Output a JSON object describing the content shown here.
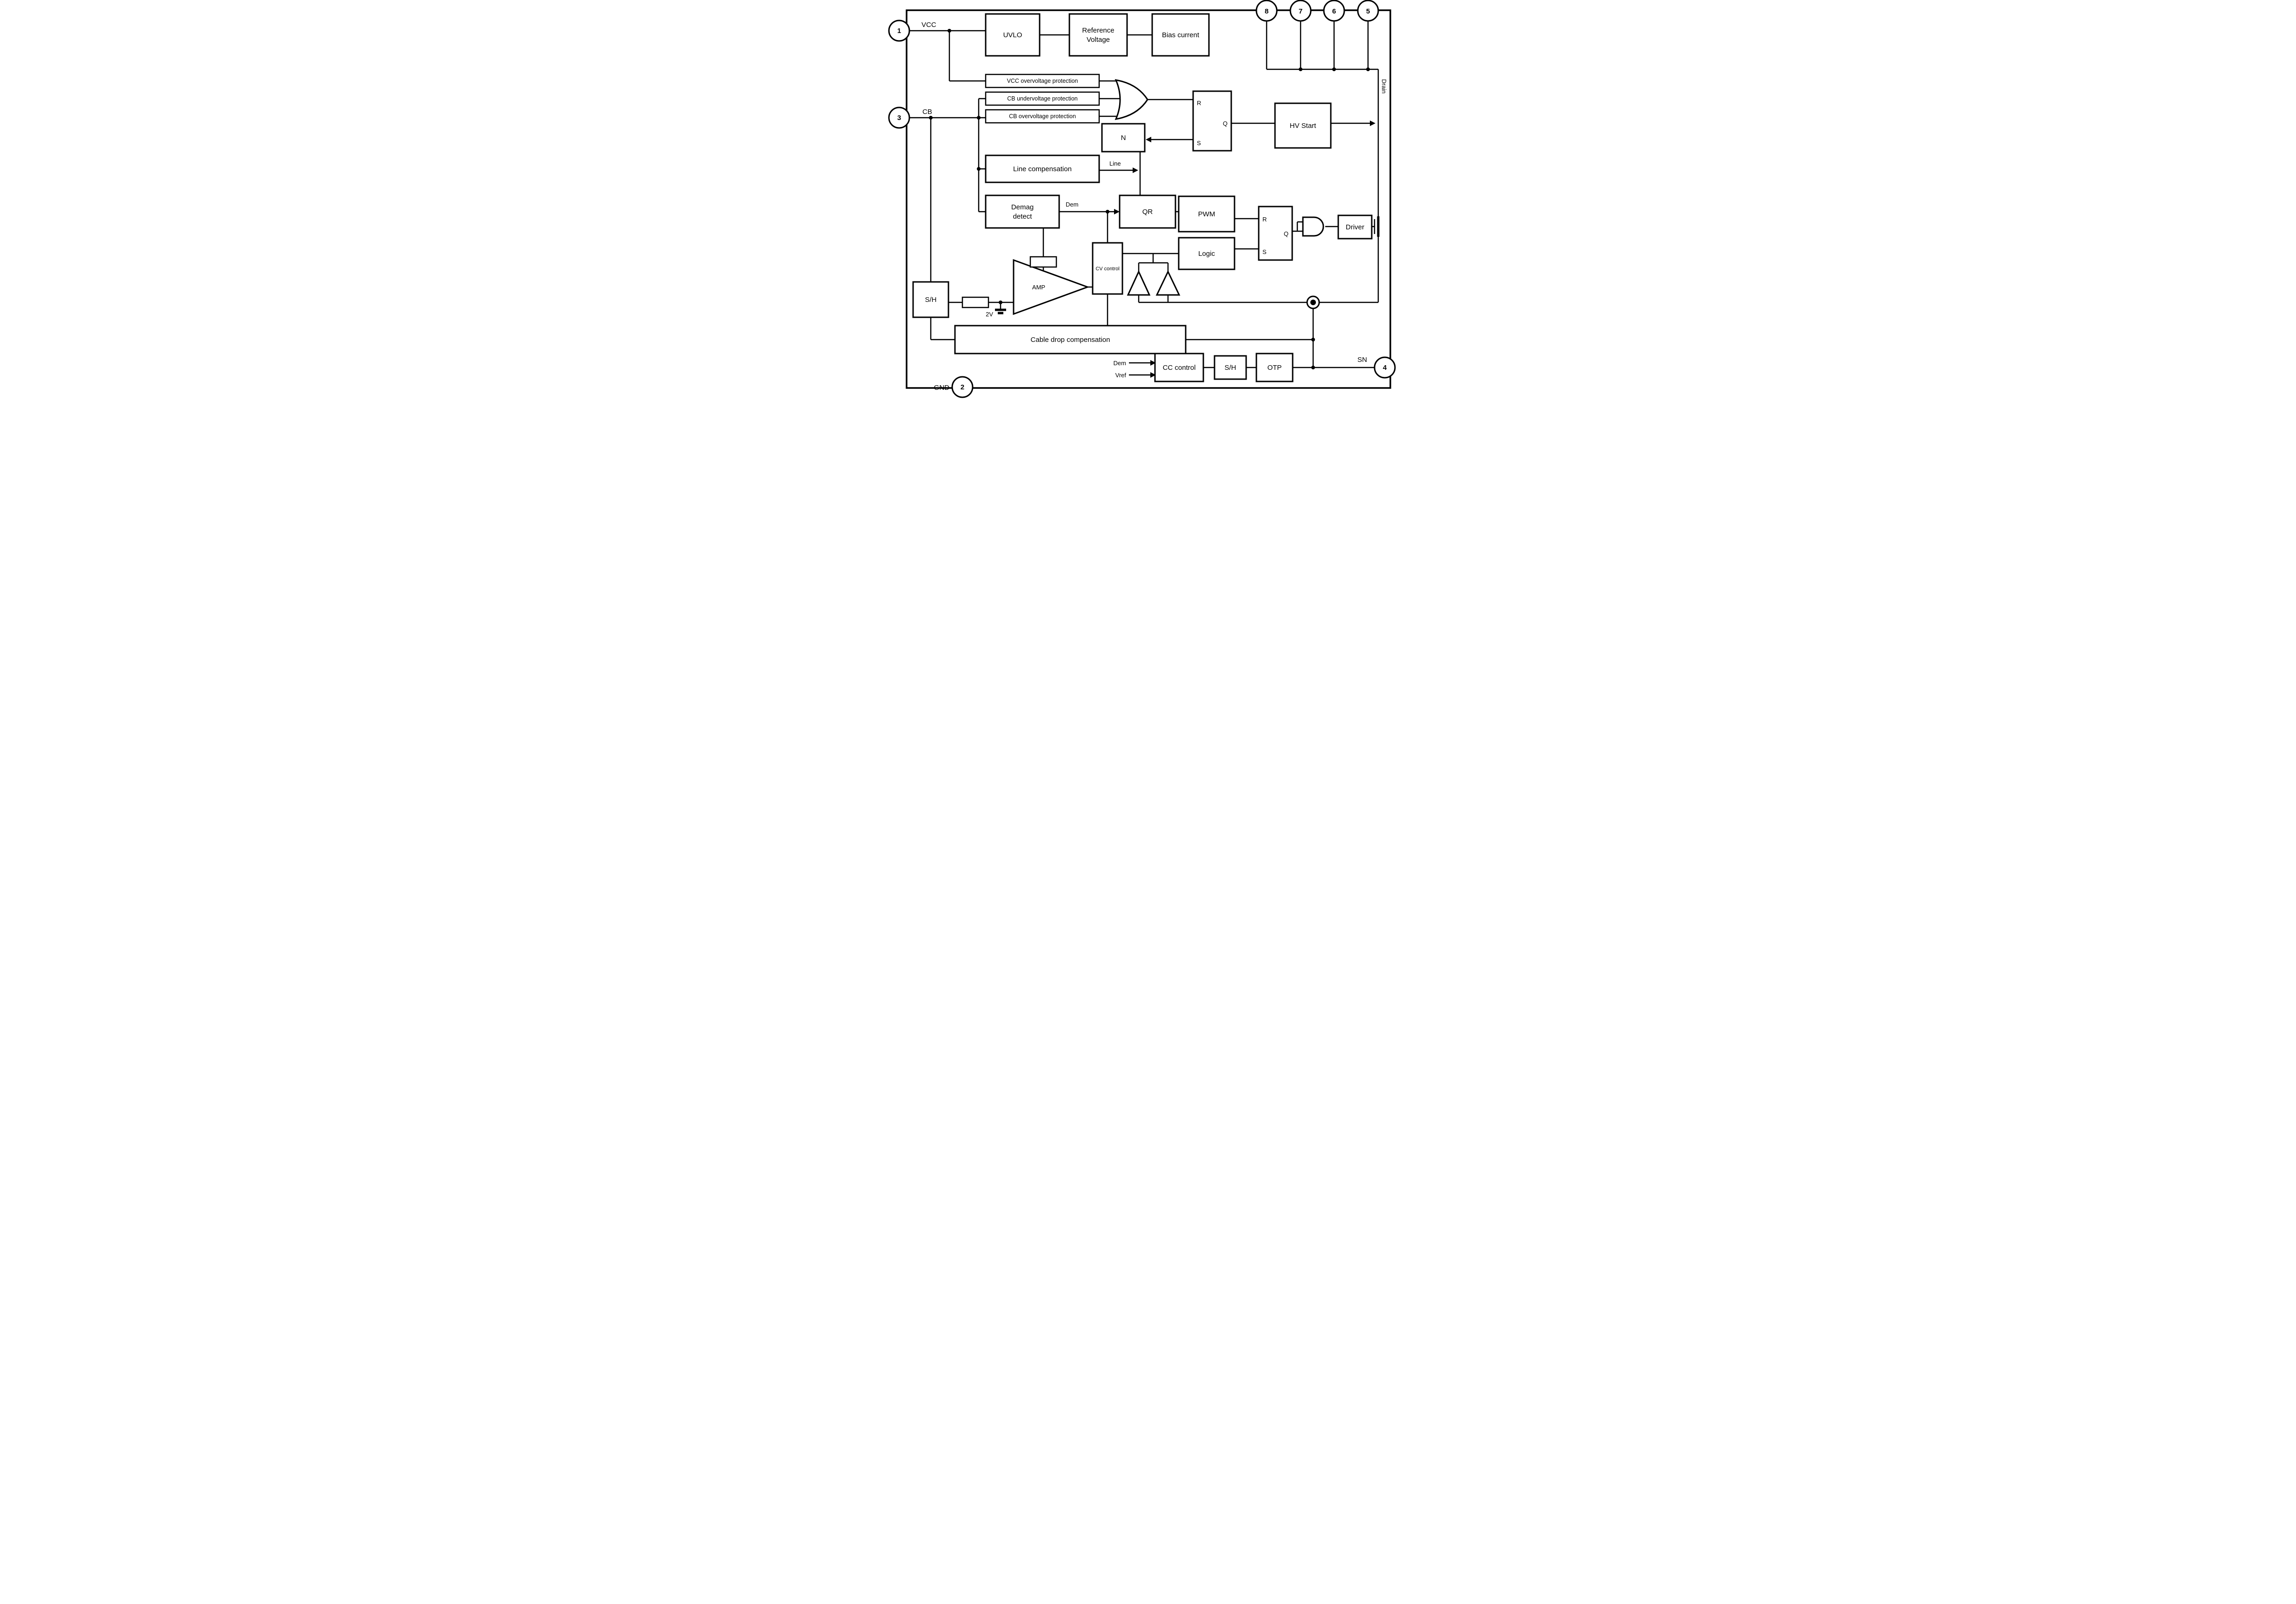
{
  "diagram": {
    "colors": {
      "line": "#000000",
      "background": "#ffffff"
    },
    "pins": {
      "p1": "1",
      "p2": "2",
      "p3": "3",
      "p4": "4",
      "p5": "5",
      "p6": "6",
      "p7": "7",
      "p8": "8"
    },
    "pin_names": {
      "vcc": "VCC",
      "gnd": "GND",
      "cb": "CB",
      "sn": "SN",
      "drain": "Drain"
    },
    "blocks": {
      "uvlo": "UVLO",
      "reference_line1": "Reference",
      "reference_line2": "Voltage",
      "bias": "Bias current",
      "vcc_ovp": "VCC overvoltage protection",
      "cb_uvp": "CB undervoltage protection",
      "cb_ovp": "CB overvoltage protection",
      "hv_start": "HV Start",
      "counter": "N",
      "line_comp": "Line compensation",
      "demag_line1": "Demag",
      "demag_line2": "detect",
      "qr": "QR",
      "pwm": "PWM",
      "logic": "Logic",
      "driver": "Driver",
      "cv_control": "CV control",
      "cable_drop": "Cable drop compensation",
      "cc_control": "CC control",
      "sample_hold_left": "S/H",
      "sample_hold_bottom": "S/H",
      "otp": "OTP",
      "amp": "AMP"
    },
    "latch": {
      "r": "R",
      "s": "S",
      "q": "Q"
    },
    "signals": {
      "line": "Line",
      "dem_top": "Dem",
      "dem_bottom": "Dem",
      "vref": "Vref",
      "v2": "2V"
    }
  }
}
